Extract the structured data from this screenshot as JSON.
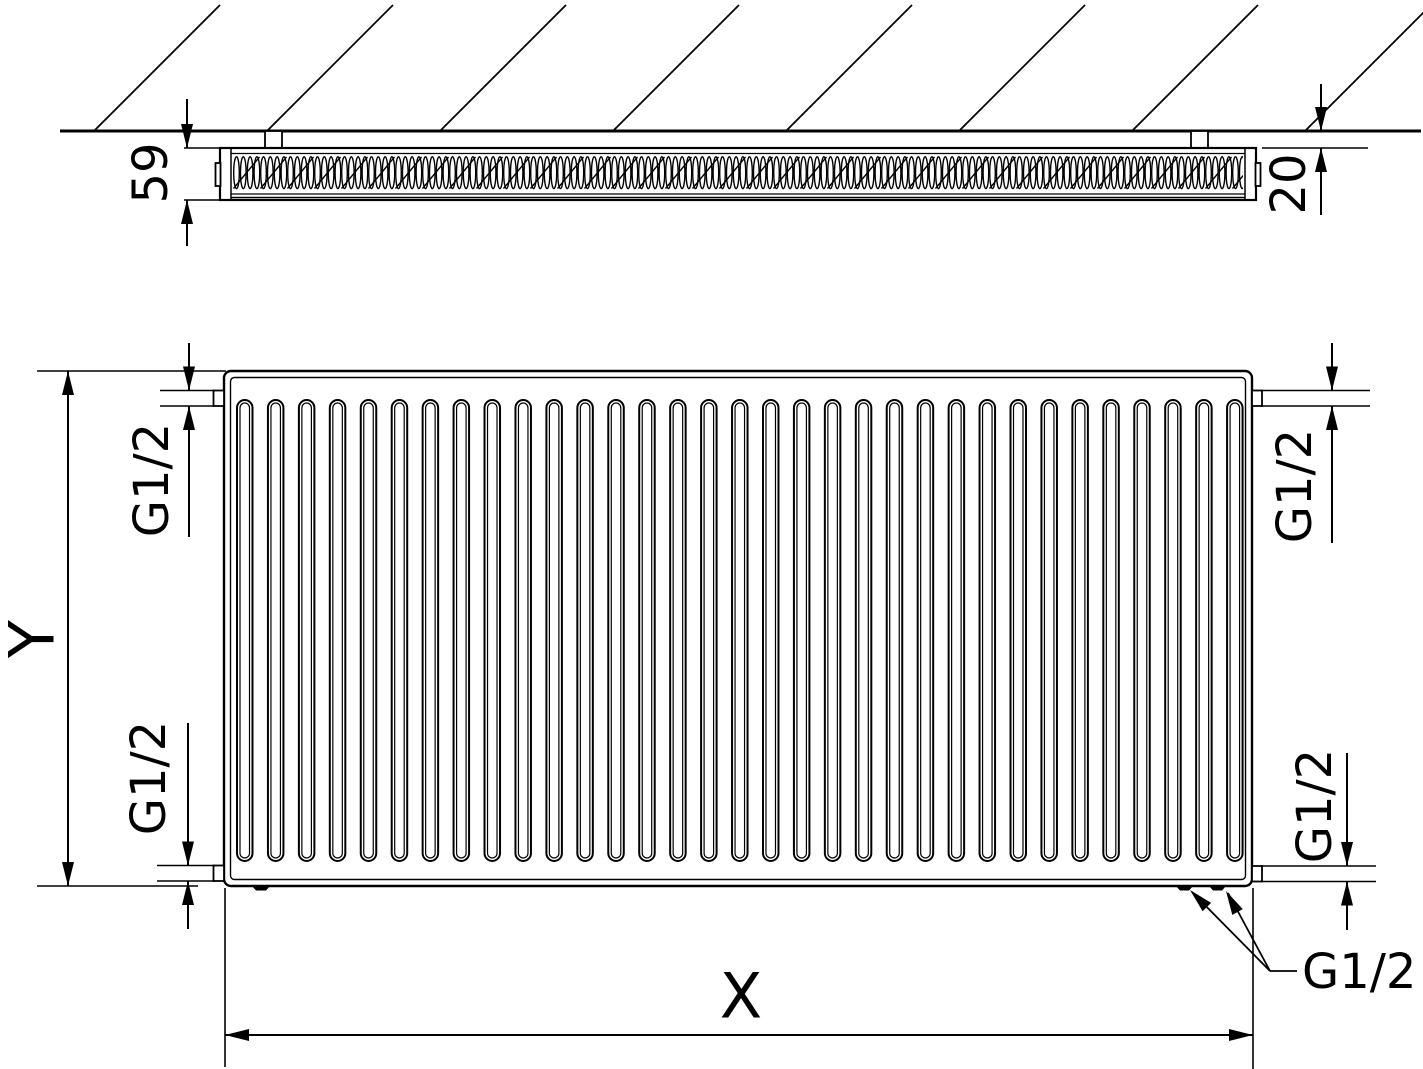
{
  "drawing": {
    "description": "radiator technical drawing, two orthographic views (top section against hatched wall, front elevation)"
  },
  "labels": {
    "depth": "59",
    "wall_distance": "20",
    "height": "Y",
    "width": "X",
    "conn_top_left": "G1/2",
    "conn_bottom_left": "G1/2",
    "conn_top_right": "G1/2",
    "conn_bottom_right": "G1/2",
    "conn_bottom_valve": "G1/2"
  },
  "colors": {
    "line": "#000000",
    "background": "#ffffff"
  }
}
